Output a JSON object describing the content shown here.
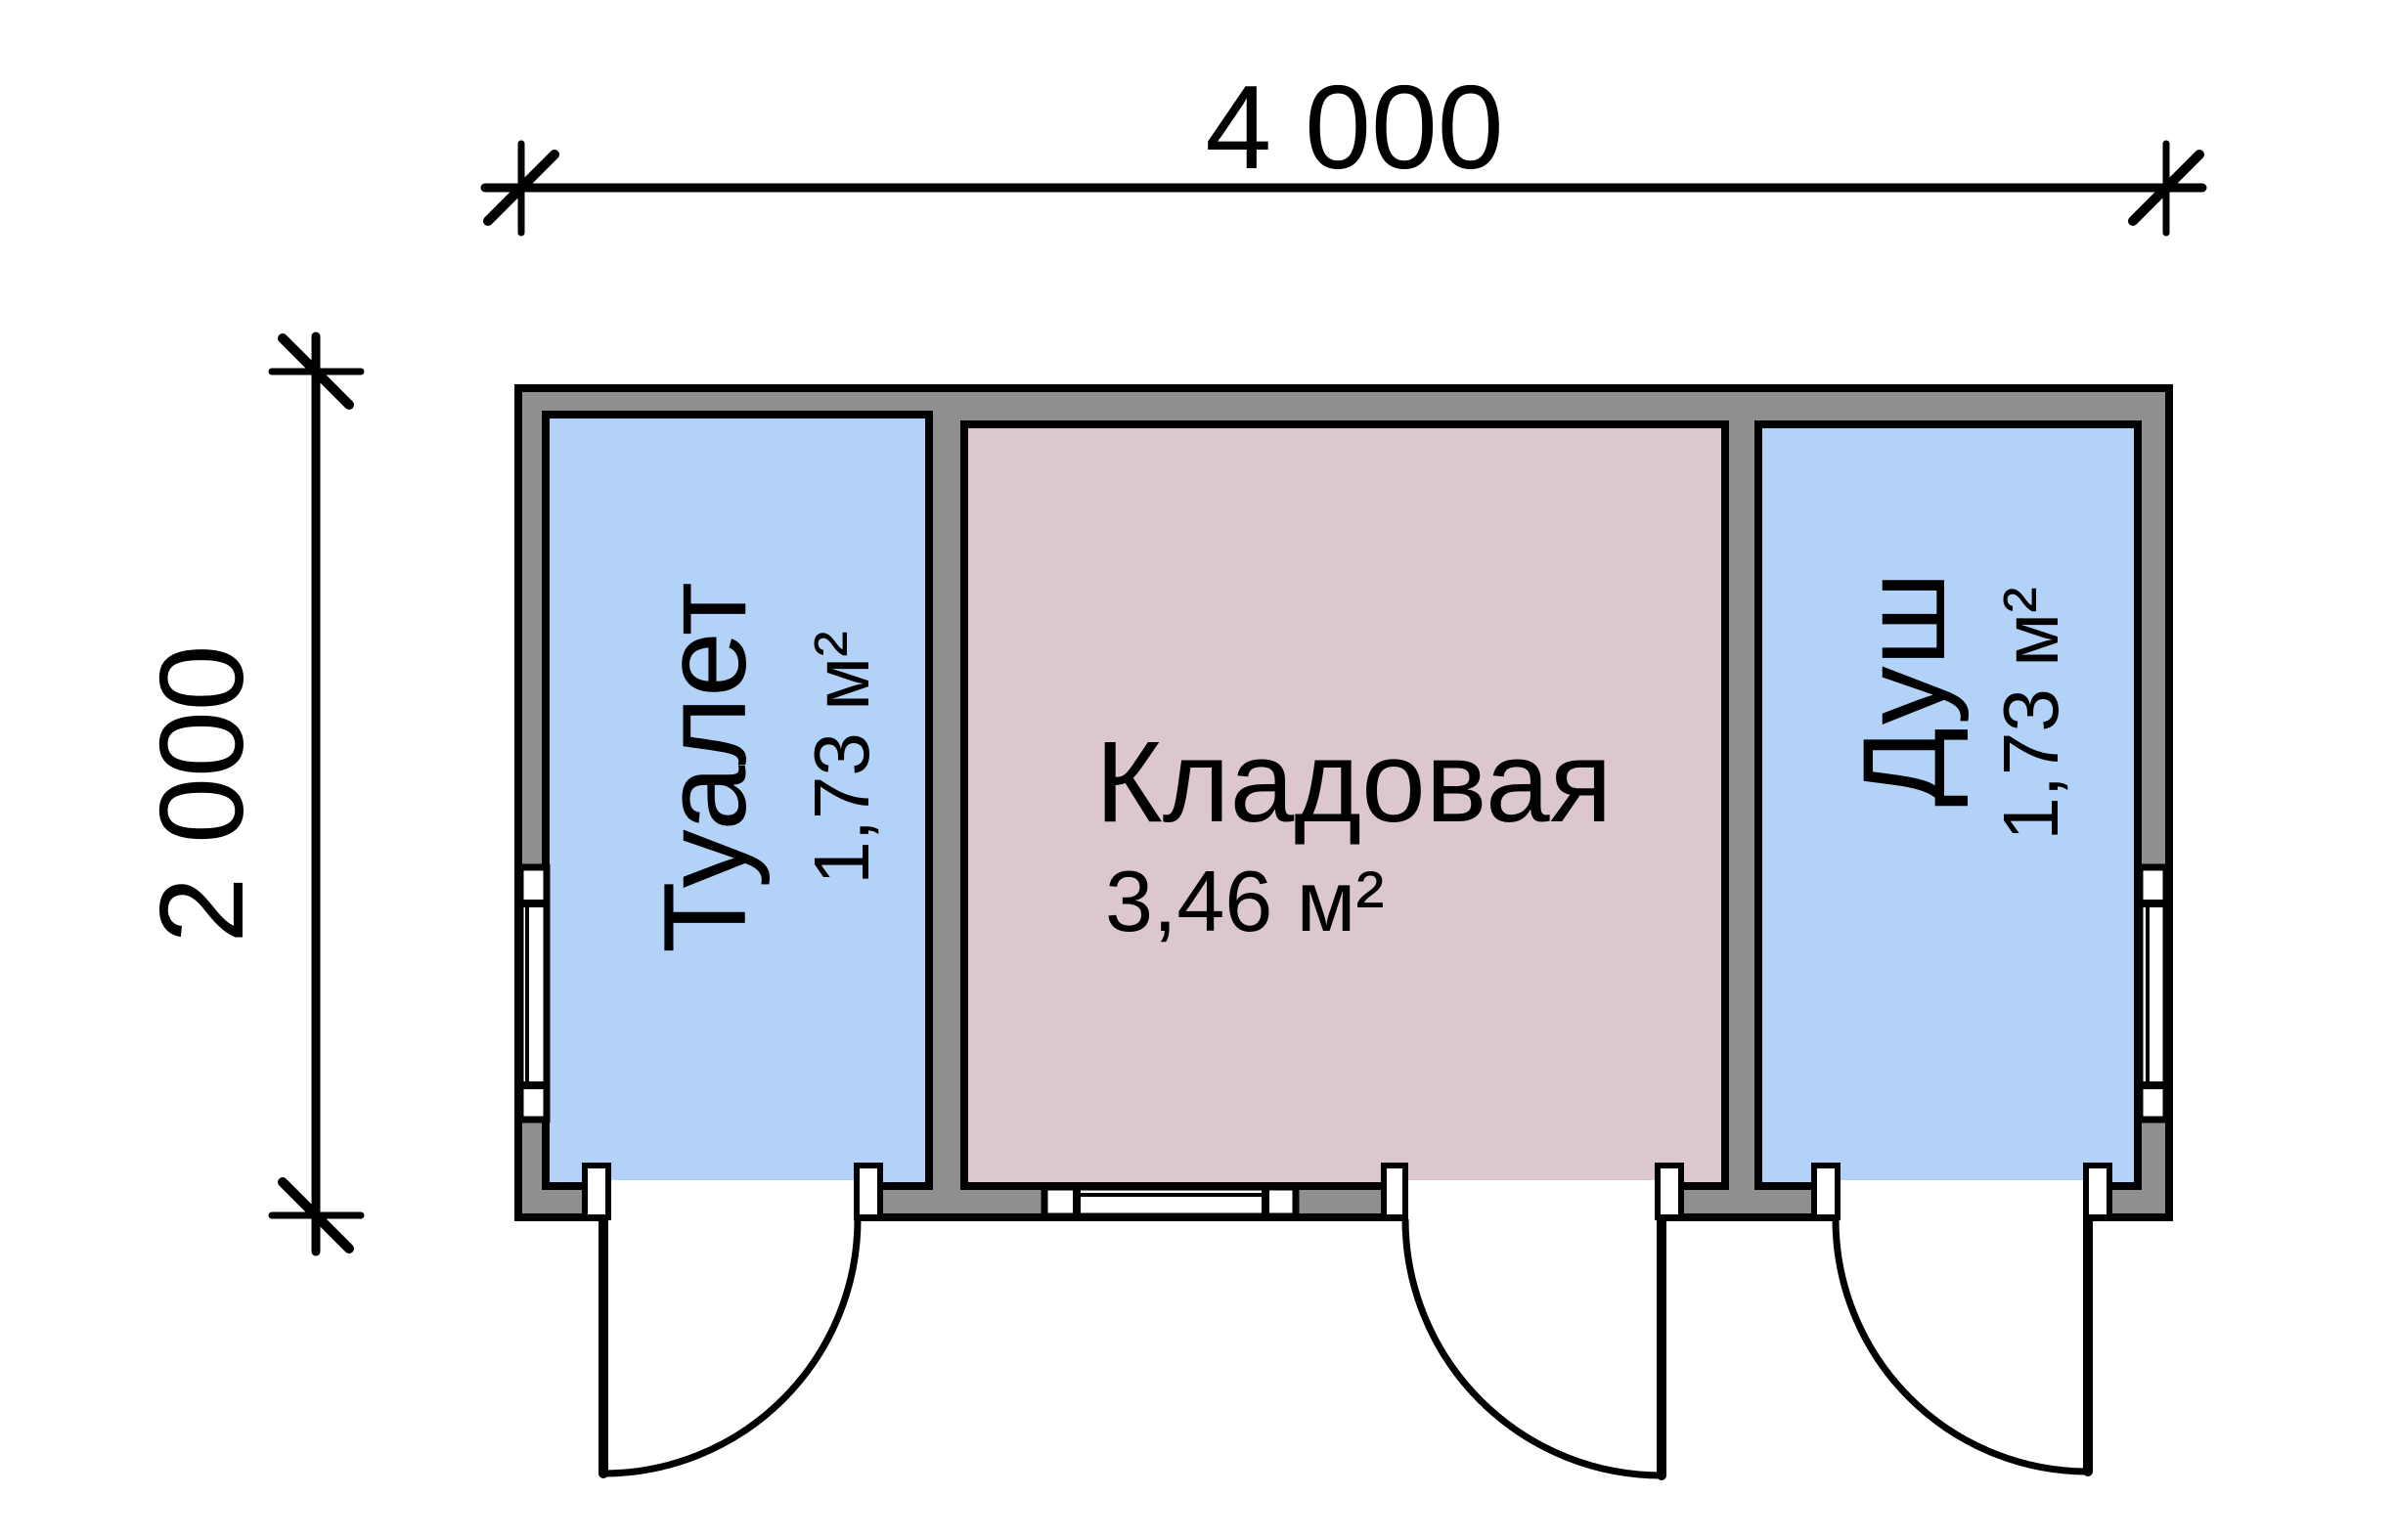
{
  "drawing": {
    "type": "floor-plan",
    "overall_width_label": "4 000",
    "overall_height_label": "2 000"
  },
  "rooms": [
    {
      "name": "Туалет",
      "area": "1,73 м²",
      "fill": "#b3d2f8"
    },
    {
      "name": "Кладовая",
      "area": "3,46 м²",
      "fill": "#dcc8cc"
    },
    {
      "name": "Душ",
      "area": "1,73 м²",
      "fill": "#b3d2f8"
    }
  ],
  "colors": {
    "wall_fill": "#8f8f8f",
    "line": "#000000",
    "window_fill": "#ffffff",
    "background": "#ffffff"
  }
}
